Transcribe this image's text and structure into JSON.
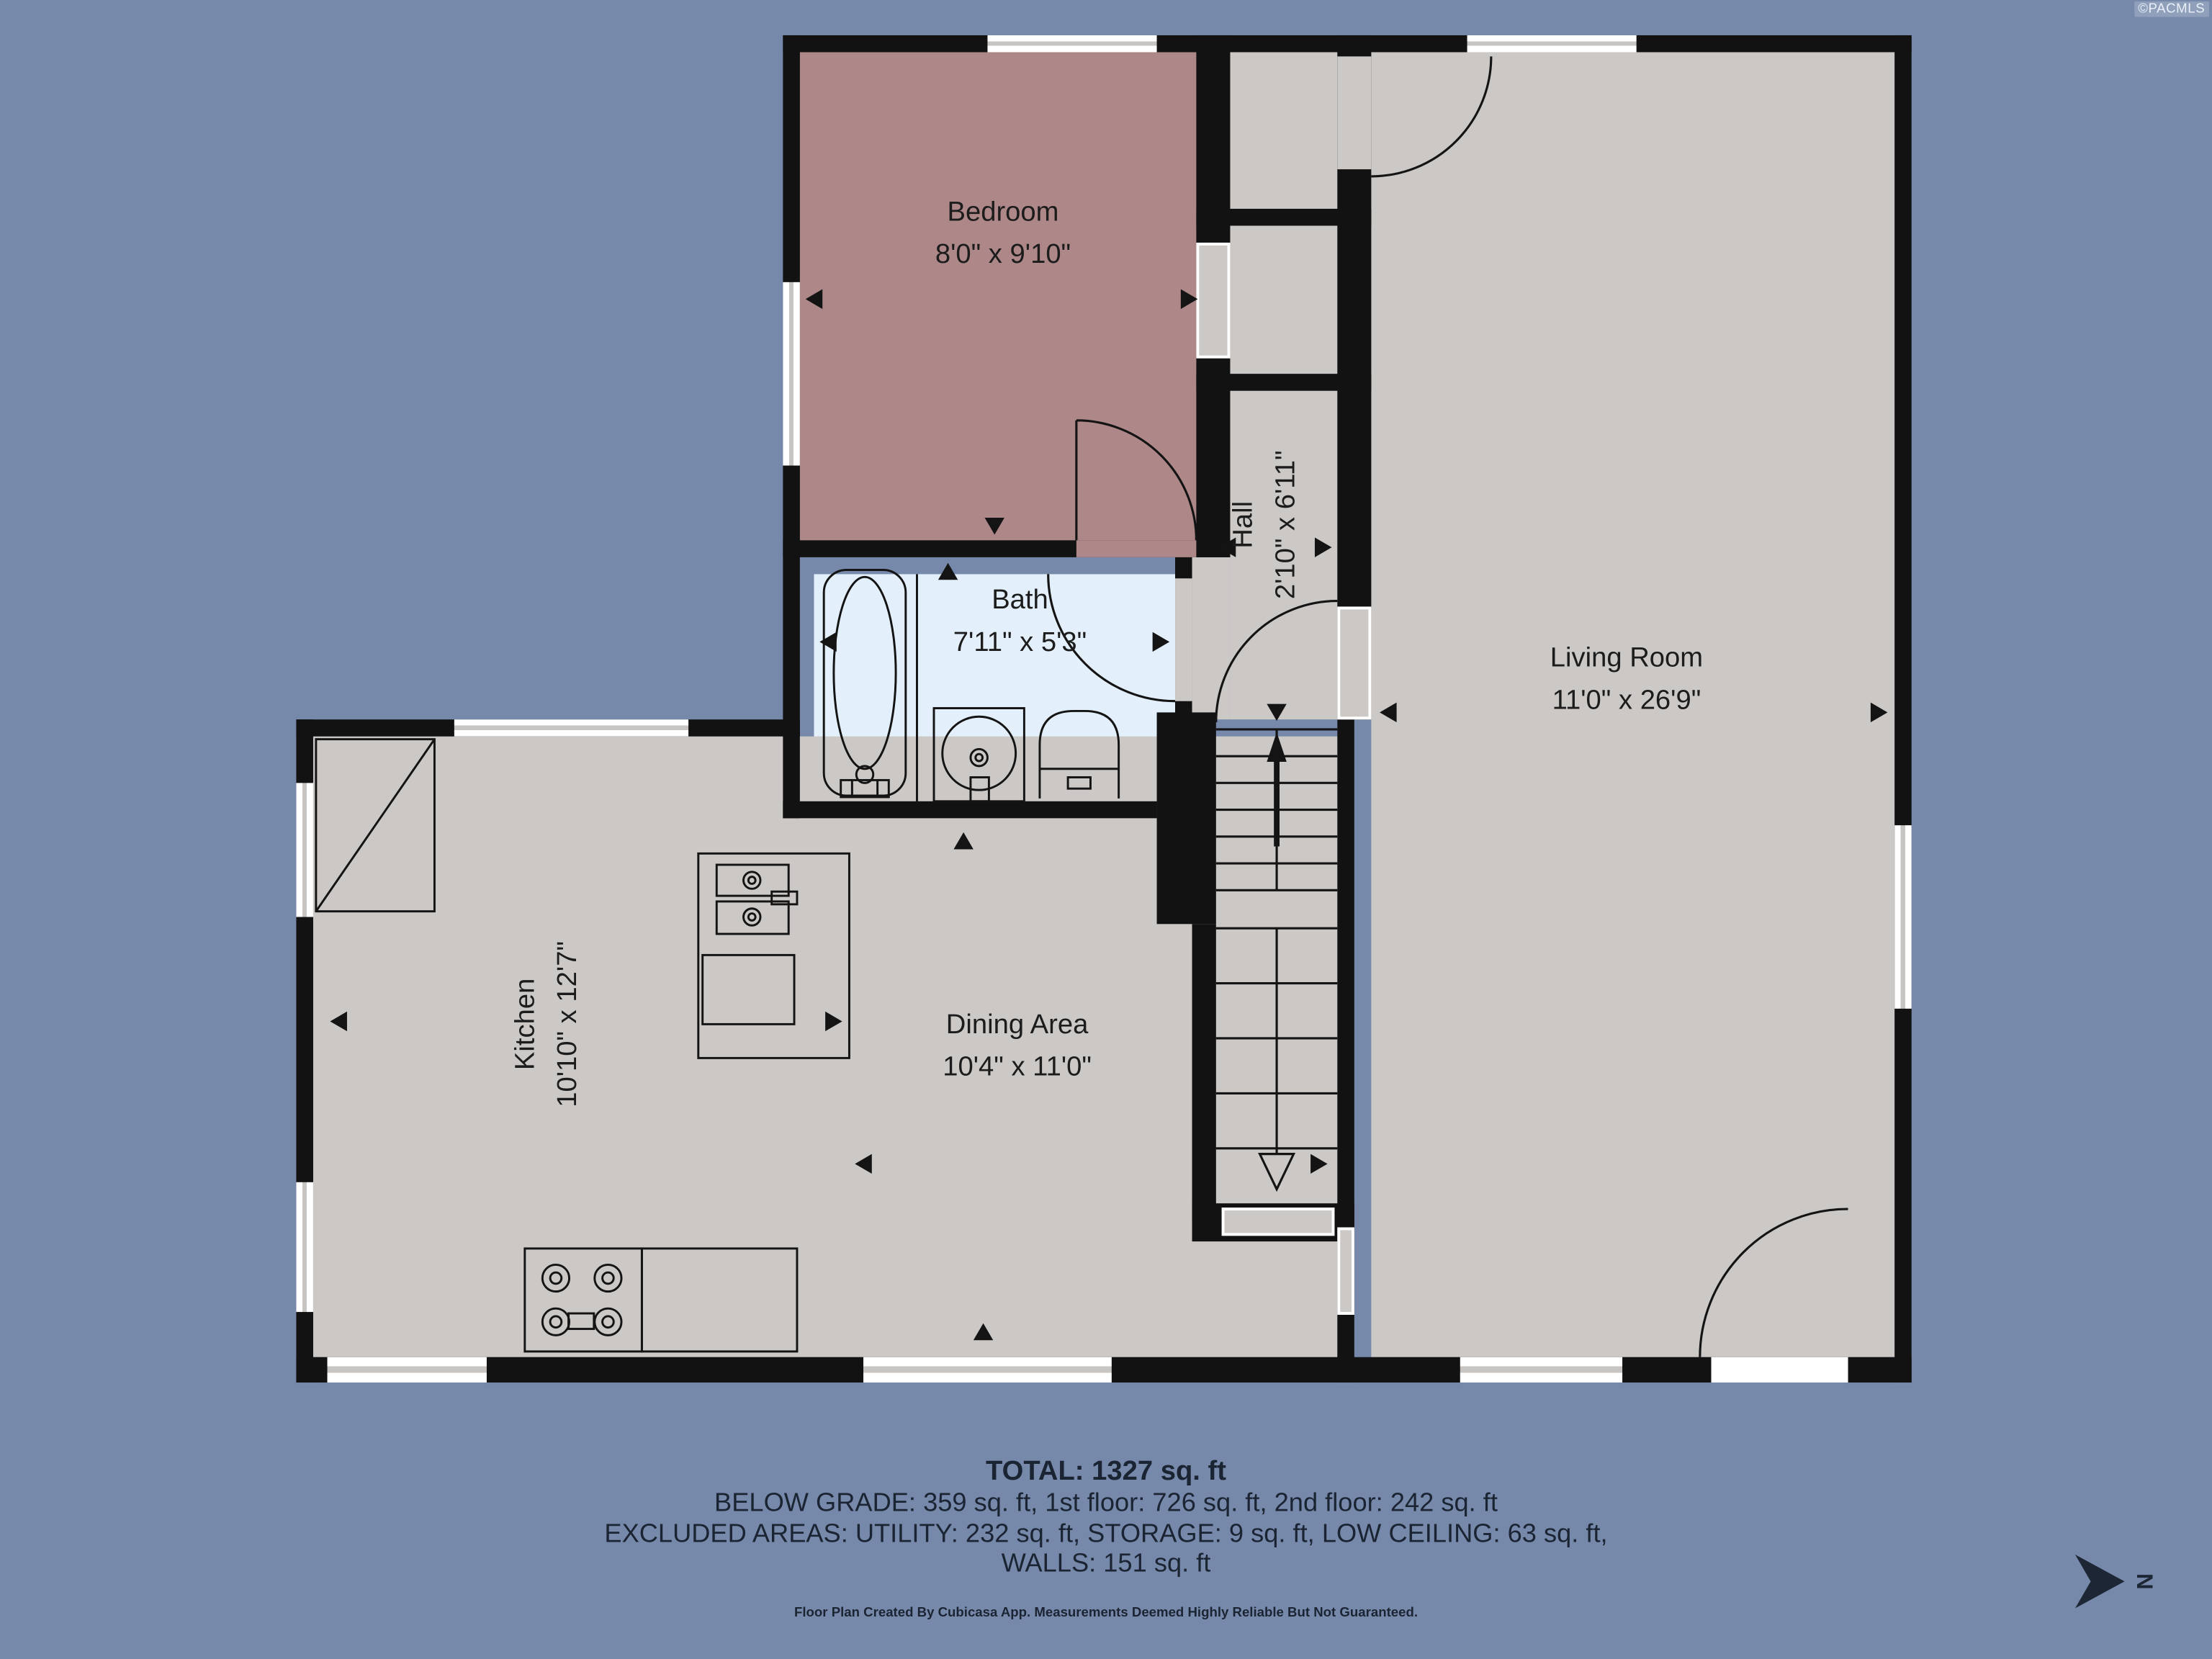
{
  "watermark": "©PACMLS",
  "rooms": {
    "bedroom": {
      "name": "Bedroom",
      "dims": "8'0\" x 9'10\""
    },
    "hall": {
      "name": "Hall",
      "dims": "2'10\" x 6'11\""
    },
    "living": {
      "name": "Living Room",
      "dims": "11'0\" x 26'9\""
    },
    "bath": {
      "name": "Bath",
      "dims": "7'11\" x 5'3\""
    },
    "kitchen": {
      "name": "Kitchen",
      "dims": "10'10\" x 12'7\""
    },
    "dining": {
      "name": "Dining Area",
      "dims": "10'4\" x 11'0\""
    }
  },
  "summary": {
    "total": "TOTAL: 1327 sq. ft",
    "floors": "BELOW GRADE: 359 sq. ft, 1st floor: 726 sq. ft, 2nd floor: 242 sq. ft",
    "excluded": "EXCLUDED AREAS: UTILITY: 232 sq. ft, STORAGE: 9 sq. ft, LOW CEILING: 63 sq. ft,",
    "walls": "WALLS: 151 sq. ft"
  },
  "footer": "Floor Plan Created By Cubicasa App. Measurements Deemed Highly Reliable But Not Guaranteed.",
  "compass": {
    "label": "N"
  },
  "colors": {
    "background": "#7689AA",
    "wall": "#121212",
    "floor": "#CBC8C6",
    "bedroom": "#AE8788",
    "bath": "#E3F0FB",
    "ink": "#1B2433"
  }
}
